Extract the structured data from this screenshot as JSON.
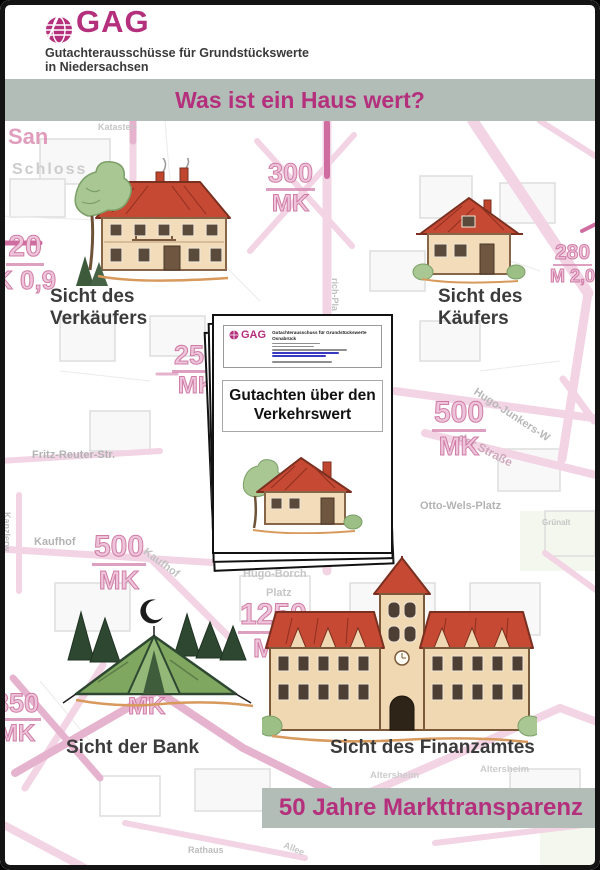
{
  "header": {
    "brand": "GAG",
    "subtitle_line1": "Gutachterausschüsse für Grundstückswerte",
    "subtitle_line2": "in Niedersachsen",
    "banner_title": "Was ist ein Haus wert?"
  },
  "footer": {
    "banner_title": "50 Jahre Markttransparenz"
  },
  "views": {
    "seller": {
      "line1": "Sicht des",
      "line2": "Verkäufers"
    },
    "buyer": {
      "line1": "Sicht des",
      "line2": "Käufers"
    },
    "bank": {
      "label": "Sicht der Bank"
    },
    "tax": {
      "label": "Sicht des Finanzamtes"
    }
  },
  "document": {
    "brand": "GAG",
    "letterhead_line1": "Gutachterausschuss für Grundstückswerte",
    "letterhead_line2": "Osnabrück",
    "title_line1": "Gutachten über den",
    "title_line2": "Verkehrswert"
  },
  "map": {
    "values": [
      {
        "num": "300",
        "unit": "MK"
      },
      {
        "num": "280",
        "unit": "M 2,0"
      },
      {
        "num": "250",
        "unit": "MK"
      },
      {
        "num": "500",
        "unit": "MK"
      },
      {
        "num": "500",
        "unit": "MK"
      },
      {
        "num": "1250",
        "unit": "MK"
      },
      {
        "num": "350",
        "unit": "MK"
      },
      {
        "num": "20",
        "unit": "K 0,9"
      },
      {
        "num": "",
        "unit": "MK"
      }
    ],
    "streets": [
      {
        "text": "San"
      },
      {
        "text": "Schloss"
      },
      {
        "text": "Kataster-"
      },
      {
        "text": "Fritz-Reuter-Str."
      },
      {
        "text": "Hugo-Junkers-W"
      },
      {
        "text": "der Straße"
      },
      {
        "text": "Otto-Wels-Platz"
      },
      {
        "text": "Grünalt"
      },
      {
        "text": "Kaufhof"
      },
      {
        "text": "Kaufhof"
      },
      {
        "text": "Hugo-Borch"
      },
      {
        "text": "Platz"
      },
      {
        "text": "Kanzlerw"
      },
      {
        "text": "rich-Pla"
      },
      {
        "text": "Altersheim"
      },
      {
        "text": "Altersheim"
      },
      {
        "text": "Rathaus"
      },
      {
        "text": "Allee"
      }
    ]
  },
  "colors": {
    "magenta": "#b42f7c",
    "banner_bg": "#b3bdb8",
    "map_pink": "#e6b3cf",
    "roof_red": "#c64934",
    "wall_cream": "#f2dcba"
  }
}
